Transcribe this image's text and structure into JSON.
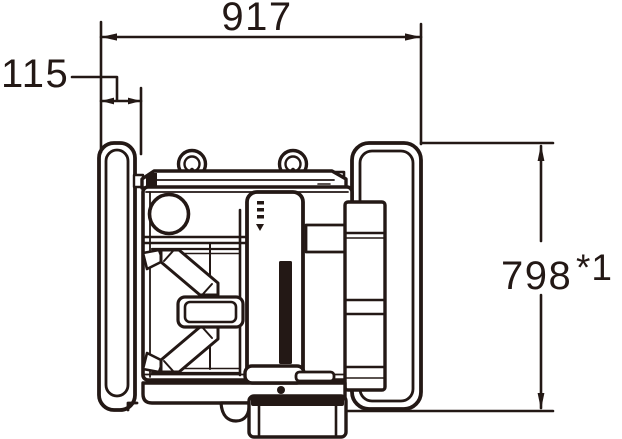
{
  "colors": {
    "ink": "#231815",
    "paper": "#ffffff"
  },
  "diagram": {
    "kind": "technical-dimension-drawing",
    "subject": "equipment-top-view",
    "dimensions": {
      "width": {
        "value": "917",
        "orientation": "horizontal",
        "position": "top"
      },
      "offset": {
        "value": "115",
        "orientation": "horizontal",
        "position": "upper-left"
      },
      "height": {
        "value": "798",
        "note": "*1",
        "orientation": "vertical",
        "position": "right"
      }
    }
  }
}
